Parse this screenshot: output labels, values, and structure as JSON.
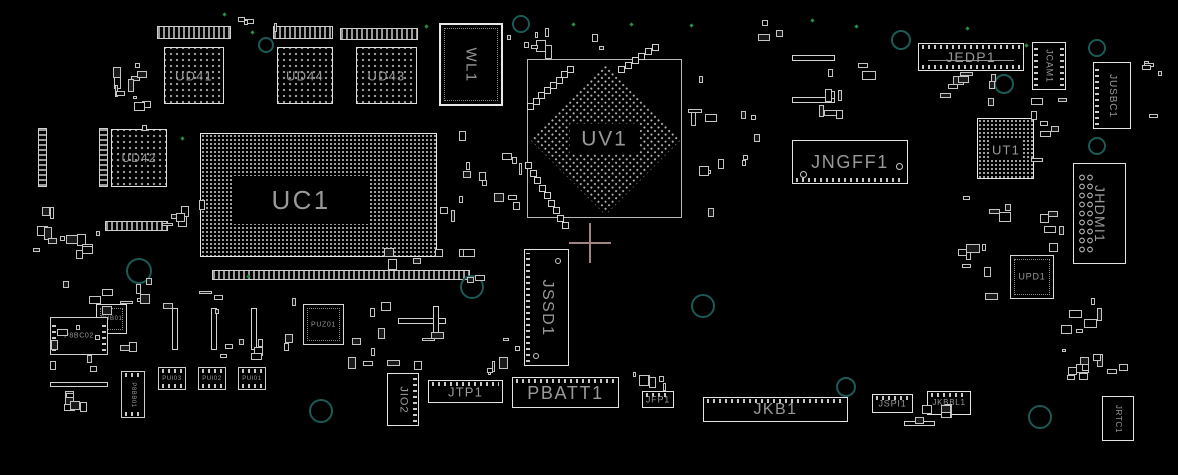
{
  "canvas": {
    "width": 1178,
    "height": 475,
    "background": "#000000"
  },
  "colors": {
    "outline": "#d7d7d7",
    "label": "#999999",
    "ring": "#1b5a55",
    "via": "#2a8f46",
    "crosshair": "#a08484"
  },
  "components": [
    {
      "label": "UD41",
      "type": "bga",
      "x": 164,
      "y": 47,
      "w": 60,
      "h": 57,
      "fs": 13
    },
    {
      "label": "UD44",
      "type": "bga",
      "x": 277,
      "y": 47,
      "w": 56,
      "h": 57,
      "fs": 13
    },
    {
      "label": "UD43",
      "type": "bga",
      "x": 356,
      "y": 47,
      "w": 61,
      "h": 57,
      "fs": 13
    },
    {
      "label": "UD42",
      "type": "bga",
      "x": 111,
      "y": 129,
      "w": 56,
      "h": 58,
      "fs": 12
    },
    {
      "label": "UC1",
      "type": "bgadense",
      "x": 200,
      "y": 133,
      "w": 237,
      "h": 124,
      "fs": 26,
      "core": [
        33,
        42,
        134,
        48
      ]
    },
    {
      "label": "UT1",
      "type": "bgadense",
      "x": 977,
      "y": 118,
      "w": 57,
      "h": 61,
      "fs": 13,
      "core": [
        11,
        21,
        34,
        19
      ]
    },
    {
      "label": "UV1",
      "type": "uv",
      "x": 527,
      "y": 59,
      "w": 155,
      "h": 159,
      "fs": 21
    },
    {
      "label": "WL1",
      "type": "module",
      "x": 439,
      "y": 23,
      "w": 64,
      "h": 83,
      "fs": 15,
      "vert": true
    },
    {
      "label": "JEDP1",
      "type": "conn",
      "x": 918,
      "y": 43,
      "w": 106,
      "h": 28,
      "fs": 14,
      "pins": [
        "top",
        "bottom"
      ],
      "slot": true
    },
    {
      "label": "JCAM1",
      "type": "conn",
      "x": 1032,
      "y": 42,
      "w": 34,
      "h": 48,
      "fs": 9,
      "vert": true,
      "pins": [
        "left",
        "right"
      ]
    },
    {
      "label": "JUSBC1",
      "type": "conn",
      "x": 1093,
      "y": 62,
      "w": 38,
      "h": 67,
      "fs": 10,
      "vert": true,
      "pins": [
        "left"
      ]
    },
    {
      "label": "JNGFF1",
      "type": "conn",
      "x": 792,
      "y": 140,
      "w": 116,
      "h": 44,
      "fs": 18,
      "pins": [
        "bottom"
      ],
      "holes": [
        [
          7,
          30,
          7
        ],
        [
          103,
          22,
          7
        ]
      ]
    },
    {
      "label": "JHDMI1",
      "type": "conn",
      "x": 1073,
      "y": 163,
      "w": 53,
      "h": 101,
      "fs": 14,
      "vert": true,
      "holecol": true
    },
    {
      "label": "JSSD1",
      "type": "conn",
      "x": 524,
      "y": 249,
      "w": 45,
      "h": 117,
      "fs": 16,
      "vert": true,
      "pins": [
        "left"
      ],
      "holes": [
        [
          30,
          8,
          6
        ],
        [
          8,
          103,
          6
        ]
      ]
    },
    {
      "label": "UPD1",
      "type": "qfn",
      "x": 1010,
      "y": 255,
      "w": 44,
      "h": 44,
      "fs": 9
    },
    {
      "label": "PUZ01",
      "type": "qfn",
      "x": 303,
      "y": 304,
      "w": 41,
      "h": 41,
      "fs": 7
    },
    {
      "label": "PUB01",
      "type": "qfn",
      "x": 96,
      "y": 304,
      "w": 31,
      "h": 30,
      "fs": 6
    },
    {
      "label": "P8BC02",
      "type": "chip",
      "x": 50,
      "y": 317,
      "w": 58,
      "h": 38,
      "fs": 7,
      "pins": [
        "left",
        "right"
      ]
    },
    {
      "label": "P8BB01",
      "type": "chip",
      "x": 121,
      "y": 371,
      "w": 24,
      "h": 47,
      "fs": 6,
      "vert": true,
      "pins": [
        "top",
        "bottom"
      ]
    },
    {
      "label": "PUI03",
      "type": "chip",
      "x": 158,
      "y": 367,
      "w": 28,
      "h": 23,
      "fs": 6,
      "pins": [
        "top",
        "bottom"
      ]
    },
    {
      "label": "PUI02",
      "type": "chip",
      "x": 198,
      "y": 367,
      "w": 28,
      "h": 23,
      "fs": 6,
      "pins": [
        "top",
        "bottom"
      ]
    },
    {
      "label": "PUI01",
      "type": "chip",
      "x": 238,
      "y": 367,
      "w": 28,
      "h": 23,
      "fs": 6,
      "pins": [
        "top",
        "bottom"
      ]
    },
    {
      "label": "JIO2",
      "type": "conn",
      "x": 387,
      "y": 373,
      "w": 32,
      "h": 53,
      "fs": 11,
      "vert": true,
      "pins": [
        "right"
      ]
    },
    {
      "label": "JTP1",
      "type": "conn",
      "x": 428,
      "y": 380,
      "w": 75,
      "h": 23,
      "fs": 13,
      "pins": [
        "top"
      ]
    },
    {
      "label": "PBATT1",
      "type": "conn",
      "x": 512,
      "y": 377,
      "w": 107,
      "h": 31,
      "fs": 18,
      "pins": [
        "top"
      ]
    },
    {
      "label": "JFP1",
      "type": "conn",
      "x": 642,
      "y": 391,
      "w": 32,
      "h": 17,
      "fs": 9,
      "pins": [
        "top"
      ]
    },
    {
      "label": "JKB1",
      "type": "conn",
      "x": 703,
      "y": 397,
      "w": 145,
      "h": 25,
      "fs": 16,
      "pins": [
        "top"
      ]
    },
    {
      "label": "JSPI1",
      "type": "conn",
      "x": 872,
      "y": 394,
      "w": 41,
      "h": 19,
      "fs": 9,
      "pins": [
        "top"
      ]
    },
    {
      "label": "JKBBL1",
      "type": "conn",
      "x": 927,
      "y": 391,
      "w": 44,
      "h": 24,
      "fs": 8,
      "pins": [
        "top"
      ]
    },
    {
      "label": "JRTC1",
      "type": "conn",
      "x": 1102,
      "y": 396,
      "w": 32,
      "h": 45,
      "fs": 8,
      "vert": true
    }
  ],
  "strips": [
    {
      "x": 157,
      "y": 26,
      "w": 74,
      "h": 13
    },
    {
      "x": 273,
      "y": 26,
      "w": 60,
      "h": 13
    },
    {
      "x": 340,
      "y": 28,
      "w": 78,
      "h": 12
    },
    {
      "x": 212,
      "y": 270,
      "w": 258,
      "h": 10
    },
    {
      "x": 105,
      "y": 221,
      "w": 63,
      "h": 10
    },
    {
      "x": 99,
      "y": 128,
      "w": 9,
      "h": 59,
      "v": true
    },
    {
      "x": 38,
      "y": 128,
      "w": 9,
      "h": 59,
      "v": true
    }
  ],
  "bars": [
    {
      "x": 792,
      "y": 55,
      "w": 43,
      "h": 6
    },
    {
      "x": 792,
      "y": 97,
      "w": 43,
      "h": 6
    },
    {
      "x": 50,
      "y": 382,
      "w": 58,
      "h": 5
    },
    {
      "x": 904,
      "y": 421,
      "w": 31,
      "h": 5
    },
    {
      "x": 398,
      "y": 318,
      "w": 48,
      "h": 6
    },
    {
      "x": 172,
      "y": 308,
      "w": 6,
      "h": 42
    },
    {
      "x": 211,
      "y": 308,
      "w": 6,
      "h": 42
    },
    {
      "x": 251,
      "y": 308,
      "w": 6,
      "h": 42
    },
    {
      "x": 433,
      "y": 306,
      "w": 6,
      "h": 33
    }
  ],
  "rings": [
    {
      "x": 521,
      "y": 24,
      "r": 9
    },
    {
      "x": 266,
      "y": 45,
      "r": 8
    },
    {
      "x": 901,
      "y": 40,
      "r": 10
    },
    {
      "x": 1004,
      "y": 84,
      "r": 10
    },
    {
      "x": 1097,
      "y": 48,
      "r": 9
    },
    {
      "x": 1097,
      "y": 146,
      "r": 9
    },
    {
      "x": 139,
      "y": 271,
      "r": 13
    },
    {
      "x": 472,
      "y": 287,
      "r": 12
    },
    {
      "x": 703,
      "y": 306,
      "r": 12
    },
    {
      "x": 321,
      "y": 411,
      "r": 12
    },
    {
      "x": 846,
      "y": 387,
      "r": 10
    },
    {
      "x": 1040,
      "y": 417,
      "r": 12
    }
  ],
  "vias": [
    {
      "x": 223,
      "y": 13
    },
    {
      "x": 251,
      "y": 31
    },
    {
      "x": 425,
      "y": 25
    },
    {
      "x": 572,
      "y": 23
    },
    {
      "x": 630,
      "y": 23
    },
    {
      "x": 690,
      "y": 24
    },
    {
      "x": 811,
      "y": 19
    },
    {
      "x": 855,
      "y": 25
    },
    {
      "x": 966,
      "y": 27
    },
    {
      "x": 1025,
      "y": 44
    },
    {
      "x": 181,
      "y": 137
    },
    {
      "x": 247,
      "y": 275
    }
  ],
  "chains": [
    {
      "x1": 527,
      "y1": 103,
      "x2": 567,
      "y2": 66,
      "n": 8
    },
    {
      "x1": 525,
      "y1": 162,
      "x2": 562,
      "y2": 222,
      "n": 9
    },
    {
      "x1": 618,
      "y1": 66,
      "x2": 652,
      "y2": 44,
      "n": 6
    }
  ],
  "clusters": [
    {
      "x": 95,
      "y": 58,
      "w": 58,
      "h": 76,
      "n": 12
    },
    {
      "x": 60,
      "y": 228,
      "w": 45,
      "h": 45,
      "n": 7
    },
    {
      "x": 148,
      "y": 196,
      "w": 62,
      "h": 32,
      "n": 6
    },
    {
      "x": 438,
      "y": 128,
      "w": 85,
      "h": 112,
      "n": 14
    },
    {
      "x": 505,
      "y": 22,
      "w": 100,
      "h": 40,
      "n": 9
    },
    {
      "x": 683,
      "y": 60,
      "w": 78,
      "h": 170,
      "n": 13
    },
    {
      "x": 795,
      "y": 40,
      "w": 88,
      "h": 88,
      "n": 9
    },
    {
      "x": 930,
      "y": 72,
      "w": 78,
      "h": 34,
      "n": 8
    },
    {
      "x": 1030,
      "y": 88,
      "w": 42,
      "h": 76,
      "n": 7
    },
    {
      "x": 958,
      "y": 190,
      "w": 58,
      "h": 122,
      "n": 11
    },
    {
      "x": 1036,
      "y": 198,
      "w": 30,
      "h": 60,
      "n": 5
    },
    {
      "x": 40,
      "y": 272,
      "w": 118,
      "h": 105,
      "n": 18
    },
    {
      "x": 162,
      "y": 286,
      "w": 136,
      "h": 78,
      "n": 13
    },
    {
      "x": 344,
      "y": 294,
      "w": 118,
      "h": 76,
      "n": 11
    },
    {
      "x": 380,
      "y": 245,
      "w": 118,
      "h": 42,
      "n": 8
    },
    {
      "x": 465,
      "y": 335,
      "w": 58,
      "h": 42,
      "n": 6
    },
    {
      "x": 628,
      "y": 367,
      "w": 50,
      "h": 24,
      "n": 6
    },
    {
      "x": 912,
      "y": 398,
      "w": 46,
      "h": 32,
      "n": 5
    },
    {
      "x": 1055,
      "y": 296,
      "w": 52,
      "h": 40,
      "n": 6
    },
    {
      "x": 1058,
      "y": 344,
      "w": 48,
      "h": 32,
      "n": 5
    },
    {
      "x": 238,
      "y": 14,
      "w": 48,
      "h": 18,
      "n": 4
    },
    {
      "x": 756,
      "y": 18,
      "w": 30,
      "h": 26,
      "n": 3
    },
    {
      "x": 60,
      "y": 390,
      "w": 45,
      "h": 30,
      "n": 5
    },
    {
      "x": 30,
      "y": 195,
      "w": 30,
      "h": 70,
      "n": 6
    },
    {
      "x": 1135,
      "y": 60,
      "w": 30,
      "h": 70,
      "n": 5
    },
    {
      "x": 1060,
      "y": 362,
      "w": 80,
      "h": 20,
      "n": 6
    }
  ],
  "crosshair": {
    "cx": 590,
    "cy": 243,
    "arm_h": 21,
    "arm_v": 20
  }
}
